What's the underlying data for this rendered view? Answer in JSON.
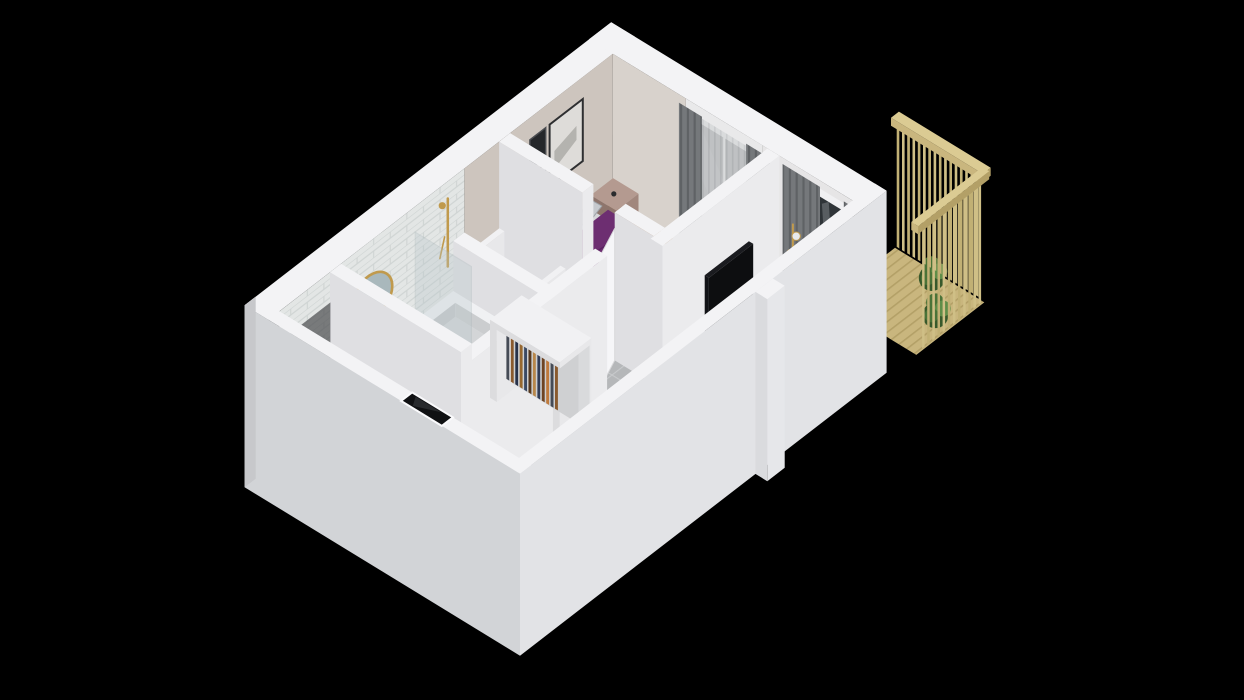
{
  "scene": {
    "title": "3D isometric floor plan of a studio apartment with balcony",
    "view": "isometric-cutaway-top",
    "background": "#000000"
  },
  "rooms": [
    {
      "name": "bedroom"
    },
    {
      "name": "bathroom"
    },
    {
      "name": "living-room"
    },
    {
      "name": "kitchen"
    },
    {
      "name": "hallway"
    },
    {
      "name": "dressing-area"
    },
    {
      "name": "balcony"
    }
  ],
  "furniture": [
    "double-bed-purple",
    "bed-pillows",
    "bed-bench",
    "bedside-table-left",
    "bedside-table-right",
    "arc-floor-lamp",
    "wall-art-frames",
    "bedroom-window",
    "bedroom-curtains",
    "bedroom-rug",
    "wardrobe-rack-bedroom",
    "wardrobe-rack-hall",
    "wardrobe-rack-niche",
    "hall-cabinet",
    "bathtub",
    "shower-glass-screen",
    "shower-fixture-gold",
    "vanity-sink",
    "oval-mirror-gold",
    "towel-blue",
    "bath-ledge",
    "bathroom-door",
    "bedroom-door",
    "tv-sideboard",
    "tv-flatscreen",
    "coffee-table-round",
    "sofa-navy",
    "living-rug-diamond",
    "potted-plant",
    "gold-floor-lamp",
    "balcony-glass-door",
    "living-curtains",
    "kitchen-counter",
    "induction-cooktop",
    "kitchen-sink",
    "kitchen-peninsula",
    "fruit-bowl-apples",
    "dining-chairs",
    "fridge-freezer",
    "washer",
    "entrance-door-dark",
    "balcony-wood-railing",
    "balcony-plants"
  ],
  "icons": {
    "freezer": "❄"
  },
  "palette": {
    "bg": "#000000",
    "rim": "#f3f3f5",
    "wall_face_u": "#ebebed",
    "wall_face_v": "#dfdfe2",
    "outer_sw": "#d2d4d7",
    "outer_se": "#e2e3e6",
    "inner_beige": "#cdc5be",
    "inner_beige_lt": "#d8d2cc",
    "inner_white": "#e6e5e6",
    "tile_hall": "#b5b7b9",
    "grout_hall": "#c8cacc",
    "tile_bath": "#bec1c2",
    "grout_bath": "#cdd0d1",
    "wood": "#a87c50",
    "wood_dark": "#96683f",
    "wood_bed": "#ab7f54",
    "kitch_base": "#d4d7d8",
    "kitch_motif": "#7e98a6",
    "kitch_dot": "#5c7482",
    "rug_base": "#ebebe9",
    "rug_diamond": "#1d1d1f",
    "subway": "#e3e6e5",
    "subway_line": "#cfd4d3",
    "balc_wood": "#c9b67e",
    "balc_wood_dark": "#b3a067",
    "balc_slat": "#cfbf86",
    "balc_slat_dark": "#c1b074",
    "rail_top": "#dbcb93",
    "plant": "#4a7338",
    "plant_dark": "#38592b",
    "plant_light": "#5f8d48",
    "bed_purple": "#6d2e71",
    "bed_purple_dark": "#5a2360",
    "bed_purple_deep": "#4c1a51",
    "pillow_gray": "#b9bcc0",
    "pillow_gray2": "#c6c9cd",
    "pillow_shadow": "#9ea3a8",
    "bed_bench": "#1d1e21",
    "rug_bed": "#d8d6d2",
    "night_top": "#b49a90",
    "night_u": "#a1877d",
    "night_v": "#8e756c",
    "lamp_black": "#2b2c2e",
    "frame_dark": "#2e2f31",
    "art_light": "#dedcd9",
    "art_mid": "#a3a19d",
    "sofa_navy": "#24405e",
    "sofa_navy_dark": "#1b3150",
    "sofa_seat": "#2c4a69",
    "cush_gray": "#9aa3ad",
    "cush_purple": "#5b2b5e",
    "tv_black": "#111216",
    "side_top": "#f2f2f4",
    "side_u": "#e8e8ea",
    "side_v": "#dcdcde",
    "table_white": "#f5f5f7",
    "gold": "#c09a4d",
    "counter_wood": "#c79a6a",
    "counter_wood_dark": "#b2885c",
    "cabinet_white": "#e9ebec",
    "cook_black": "#17181a",
    "sink_white": "#f0f2f3",
    "fridge_top": "#eef0f1",
    "fridge_u": "#e2e4e5",
    "fridge_v": "#d7d9da",
    "snow": "#8f979b",
    "entry_dark": "#101113",
    "glass_dark": "#2f3438",
    "glass_sheen": "#9aa1a6",
    "curtain": "#75787b",
    "curtain_dark": "#5f6265",
    "sheer": "#d6d8d9",
    "sheer_dark": "#c6c8ca",
    "window_dark": "#3c4043",
    "mirror_glass": "#a9b8bc",
    "towel_blue": "#3f6ea6",
    "towel_blue_dark": "#315c92",
    "door_white": "#f6f6f8",
    "chair_gray": "#8e9194",
    "chair_dark": "#5d6063",
    "niche_dark": "#35373a",
    "basin_in": "#d3d5d7",
    "basin_wall": "#c6c8ca",
    "clothes": [
      "#313c55",
      "#6e4423",
      "#c07a3c",
      "#454b56",
      "#8a5a2e",
      "#273149",
      "#97682f",
      "#3c4a63",
      "#55381f",
      "#b8874a"
    ]
  }
}
